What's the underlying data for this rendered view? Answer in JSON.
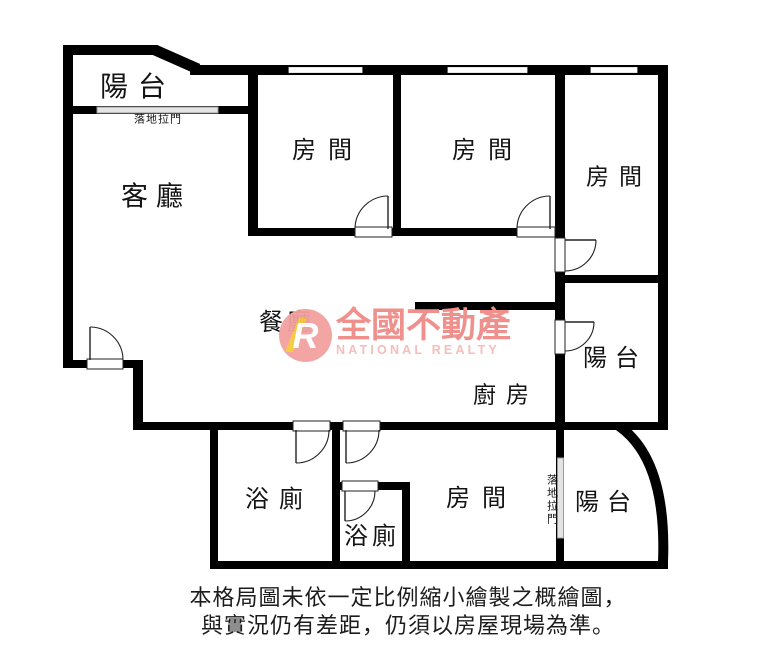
{
  "rooms": {
    "balcony_top": "陽台",
    "living": "客廳",
    "bedroom1": "房間",
    "bedroom2": "房間",
    "bedroom3": "房間",
    "dining": "餐廳",
    "kitchen": "廚房",
    "balcony_right": "陽台",
    "bath1": "浴廁",
    "bath2": "浴廁",
    "bedroom4": "房間",
    "balcony_bottom": "陽台"
  },
  "annotations": {
    "sliding_door_top": "落地拉門",
    "sliding_door_bottom": "落地拉門"
  },
  "watermark": {
    "logo_letter": "R",
    "brand": "全國不動產",
    "brand_en": "NATIONAL REALTY",
    "circle_color": "#f2a19e",
    "brand_color": "#f0908c",
    "brand_en_color": "#f6bdbb",
    "accent_color": "#f8c93e"
  },
  "disclaimer": {
    "line1": "本格局圖未依一定比例縮小繪製之概繪圖，",
    "line2": "與實況仍有差距，仍須以房屋現場為準。"
  },
  "colors": {
    "wall": "#000000",
    "background": "#ffffff",
    "sliding_door_fill": "#e4e4e4"
  }
}
